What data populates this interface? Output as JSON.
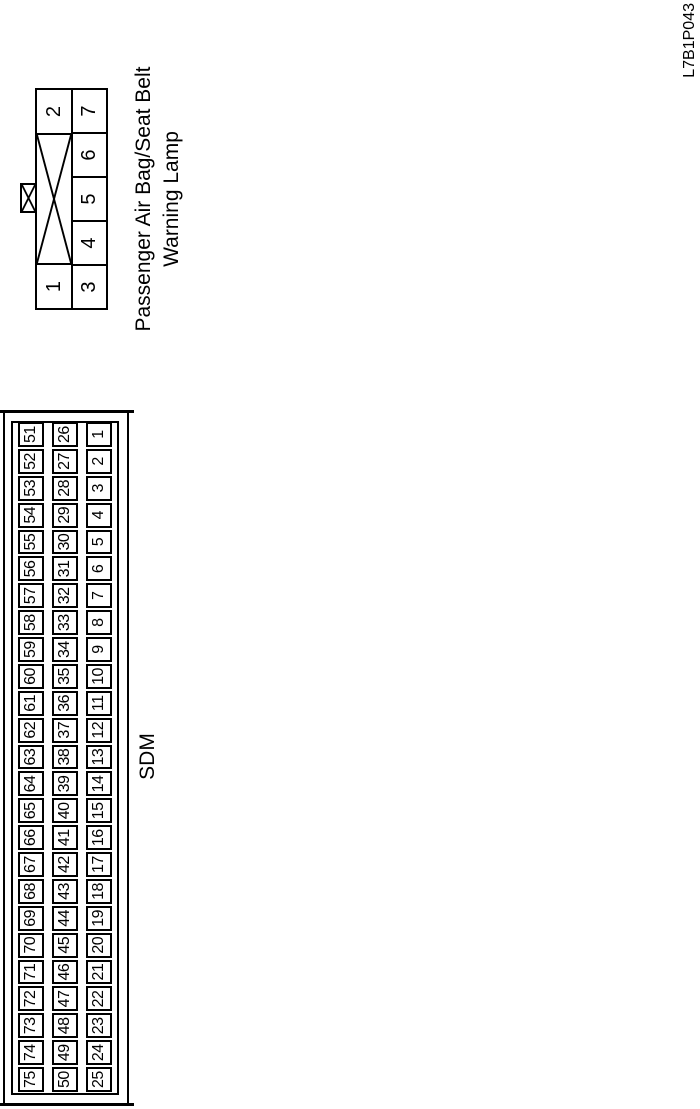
{
  "page": {
    "background": "#ffffff",
    "line_color": "#000000",
    "code_label": "L7B1P043"
  },
  "sdm_connector": {
    "label": "SDM",
    "rows": [
      {
        "name": "top",
        "cells": [
          75,
          74,
          73,
          72,
          71,
          70,
          69,
          68,
          67,
          66,
          65,
          64,
          63,
          62,
          61,
          60,
          59,
          58,
          57,
          56,
          55,
          54,
          53,
          52,
          51
        ]
      },
      {
        "name": "middle",
        "cells": [
          50,
          49,
          48,
          47,
          46,
          45,
          44,
          43,
          42,
          41,
          40,
          39,
          38,
          37,
          36,
          35,
          34,
          33,
          32,
          31,
          30,
          29,
          28,
          27,
          26
        ]
      },
      {
        "name": "bottom",
        "cells": [
          25,
          24,
          23,
          22,
          21,
          20,
          19,
          18,
          17,
          16,
          15,
          14,
          13,
          12,
          11,
          10,
          9,
          8,
          7,
          6,
          5,
          4,
          3,
          2,
          1
        ]
      }
    ]
  },
  "lamp_connector": {
    "label_line1": "Passenger Air Bag/Seat Belt",
    "label_line2": "Warning Lamp",
    "pin_top_left": "1",
    "pin_top_right": "2",
    "bottom_row_cells": [
      "3",
      "4",
      "5",
      "6",
      "7"
    ]
  }
}
